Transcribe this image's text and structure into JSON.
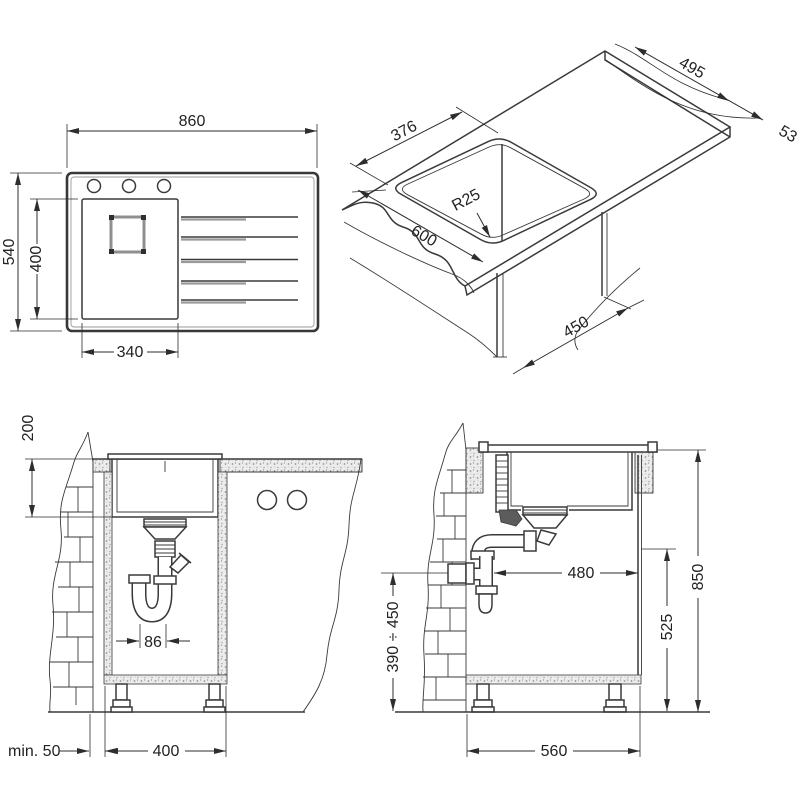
{
  "document": {
    "type": "sink installation technical drawing",
    "views": [
      "top view",
      "isometric view",
      "front section",
      "side section"
    ]
  },
  "colors": {
    "line": "#3a3a3a",
    "dim_line": "#2d2d2d",
    "text": "#222222",
    "hatch_fill": "#ececec",
    "hatch_dot": "#949494",
    "background": "#ffffff"
  },
  "top_view": {
    "dim_overall_width": "860",
    "dim_overall_depth": "540",
    "dim_bowl_length": "400",
    "dim_bowl_width": "340"
  },
  "iso_view": {
    "dim_worktop_depth": "495",
    "dim_worktop_thickness": "53",
    "dim_cutout_width": "376",
    "dim_corner_radius": "R25",
    "dim_cutout_length": "600",
    "dim_cabinet_depth": "450"
  },
  "front_section": {
    "dim_bowl_depth": "200",
    "dim_trap_offset": "86",
    "dim_wall_clearance": "min. 50",
    "dim_cabinet_inner_width": "400"
  },
  "side_section": {
    "dim_drain_to_front": "480",
    "dim_worktop_height": "850",
    "dim_inner_height": "525",
    "dim_drain_height_range": "390 ÷ 450",
    "dim_cabinet_depth": "560"
  }
}
